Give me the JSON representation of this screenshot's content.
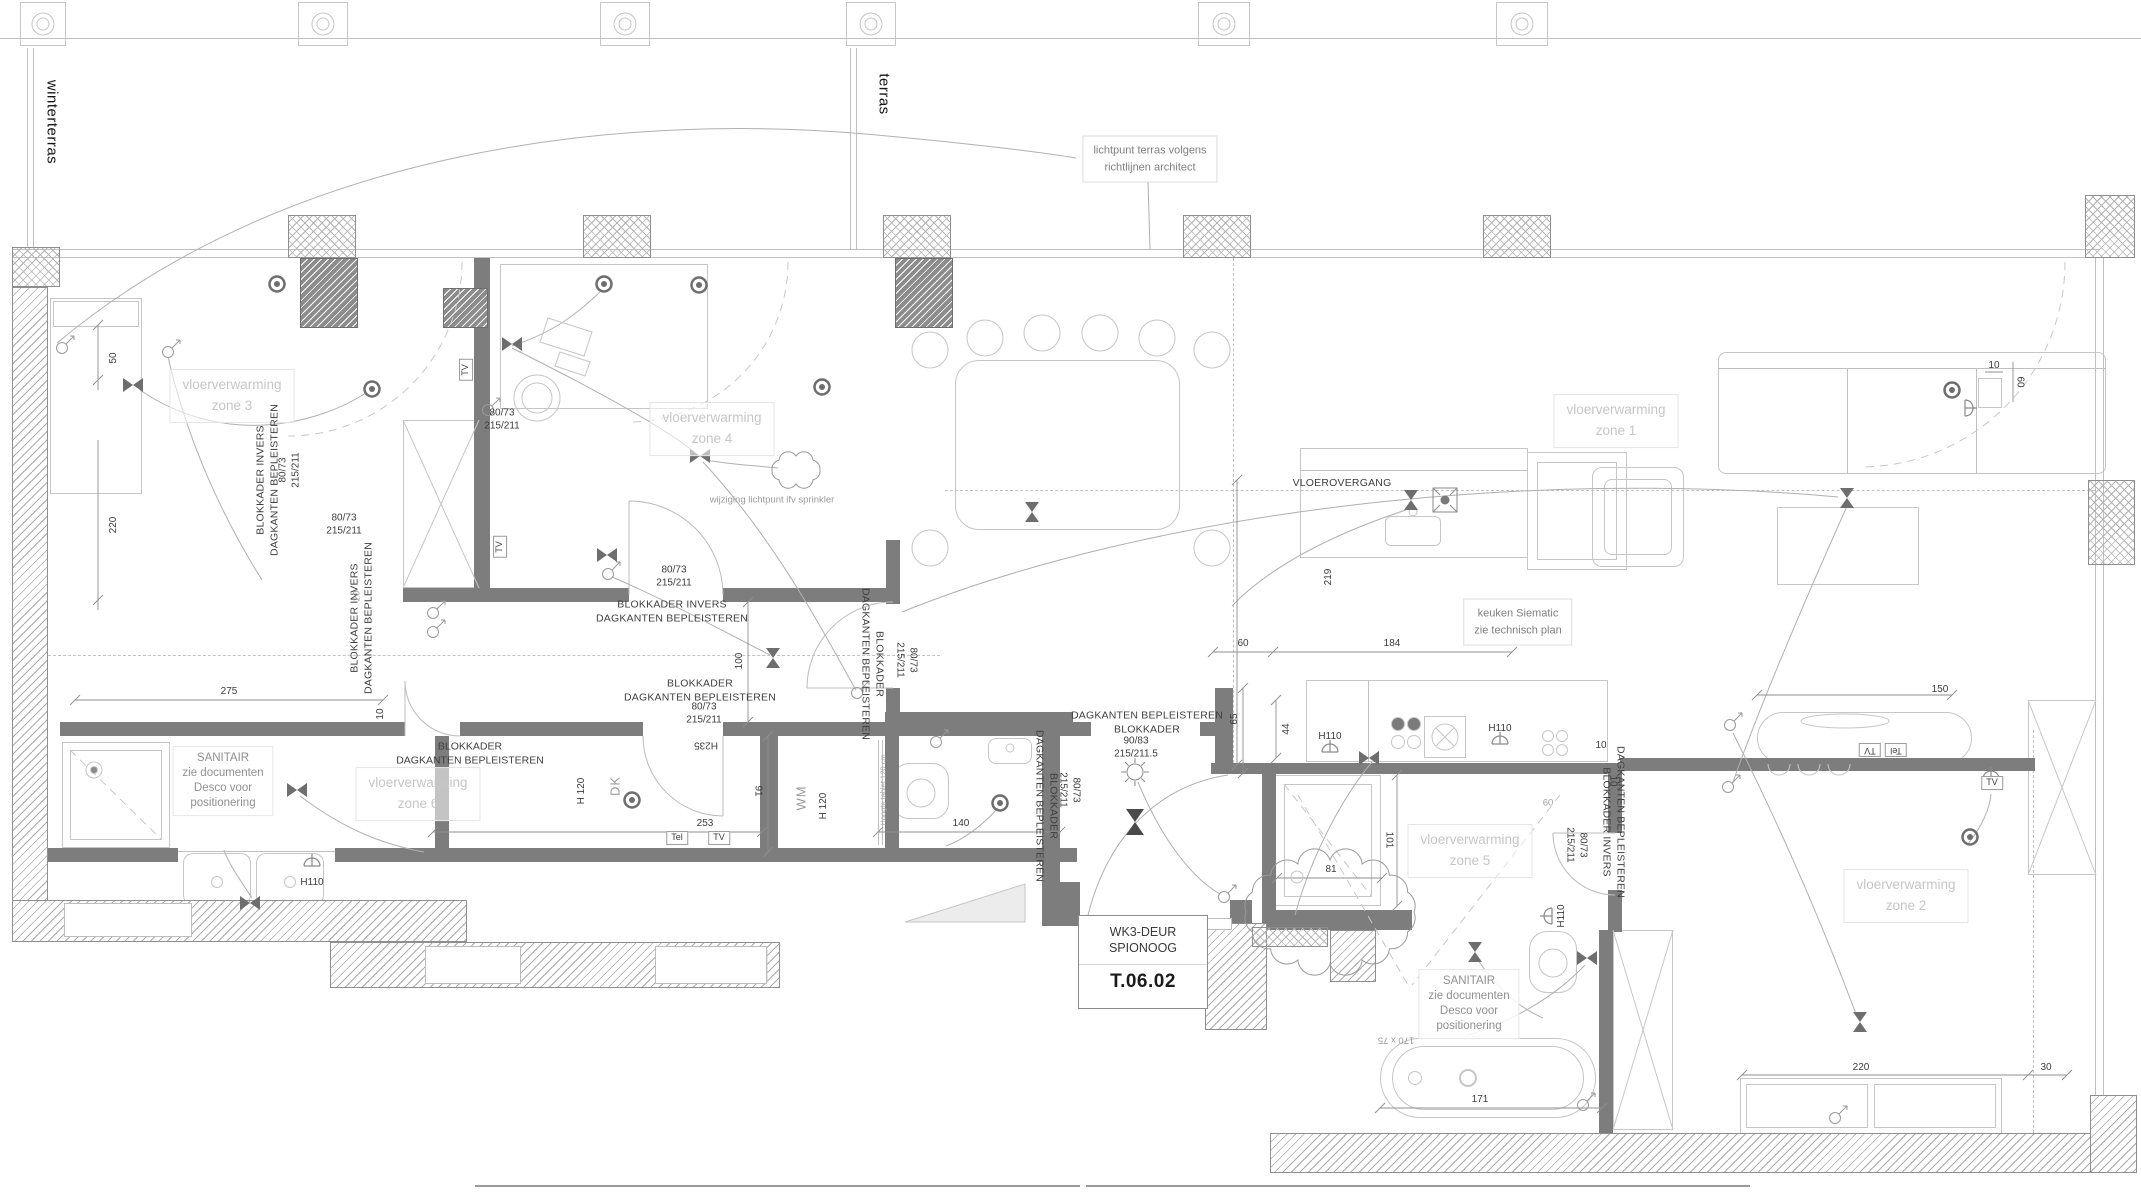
{
  "colors": {
    "wall": "#7d7d7d",
    "annotation": "#3f3f3f",
    "zone_label": "#c6c6c6",
    "dim_text": "#3c3c3c",
    "accent_none": "#ffffff"
  },
  "entry_door_tag": {
    "line1": "WK3-DEUR",
    "line2": "SPIONOOG",
    "code": "T.06.02"
  },
  "labels": [
    {
      "n": "label-winterterras",
      "t": "winterterras",
      "x": 52,
      "y": 122,
      "r": 90,
      "c": "big"
    },
    {
      "n": "label-terras",
      "t": "terras",
      "x": 884,
      "y": 94,
      "r": 90,
      "c": "big"
    },
    {
      "n": "note-lichtpunt-terras",
      "t": "lichtpunt terras volgens\nrichtlijnen architect",
      "x": 1150,
      "y": 159,
      "c": "notebox"
    },
    {
      "n": "zone-label-3",
      "t": "vloerverwarming\nzone 3",
      "x": 232,
      "y": 396,
      "c": "zone"
    },
    {
      "n": "zone-label-4",
      "t": "vloerverwarming\nzone 4",
      "x": 712,
      "y": 429,
      "c": "zone"
    },
    {
      "n": "zone-label-1",
      "t": "vloerverwarming\nzone 1",
      "x": 1616,
      "y": 421,
      "c": "zone"
    },
    {
      "n": "zone-label-2",
      "t": "vloerverwarming\nzone 2",
      "x": 1906,
      "y": 896,
      "c": "zone"
    },
    {
      "n": "zone-label-5",
      "t": "vloerverwarming\nzone 5",
      "x": 1470,
      "y": 851,
      "c": "zone"
    },
    {
      "n": "zone-label-6",
      "t": "vloerverwarming\nzone 6",
      "x": 418,
      "y": 794,
      "c": "zone"
    },
    {
      "n": "note-sanitair-left",
      "t": "SANITAIR\nzie documenten\nDesco voor\npositionering",
      "x": 223,
      "y": 781,
      "c": "sanit"
    },
    {
      "n": "note-sanitair-right",
      "t": "SANITAIR\nzie documenten\nDesco voor\npositionering",
      "x": 1469,
      "y": 1004,
      "c": "sanit"
    },
    {
      "n": "note-blokkader-invers",
      "t": "BLOKKADER INVERS\nDAGKANTEN BEPLEISTEREN",
      "x": 672,
      "y": 612,
      "c": "note"
    },
    {
      "n": "note-blokkader",
      "t": "BLOKKADER\nDAGKANTEN BEPLEISTEREN",
      "x": 700,
      "y": 691,
      "c": "note"
    },
    {
      "n": "door-spec",
      "t": "80/73\n215/211",
      "x": 674,
      "y": 577,
      "c": "dim"
    },
    {
      "n": "door-spec",
      "t": "80/73\n215/211",
      "x": 704,
      "y": 714,
      "c": "dim"
    },
    {
      "n": "note-blokkader",
      "t": "BLOKKADER\nDAGKANTEN BEPLEISTEREN",
      "x": 470,
      "y": 754,
      "c": "noteL"
    },
    {
      "n": "note-entry-door",
      "t": "DAGKANTEN BEPLEISTEREN\nBLOKKADER",
      "x": 1147,
      "y": 723,
      "c": "note"
    },
    {
      "n": "door-spec-entry",
      "t": "90/83\n215/211.5",
      "x": 1136,
      "y": 748,
      "c": "dim"
    },
    {
      "n": "door-spec",
      "t": "80/73\n215/211",
      "x": 502,
      "y": 420,
      "c": "dim"
    },
    {
      "n": "door-spec",
      "t": "80/73\n215/211",
      "x": 344,
      "y": 525,
      "c": "dim"
    },
    {
      "n": "note-blokkader-v",
      "t": "BLOKKADER INVERS\nDAGKANTEN BEPLEISTEREN",
      "x": 268,
      "y": 480,
      "r": -90,
      "c": "note"
    },
    {
      "n": "note-blokkader-v",
      "t": "BLOKKADER INVERS\nDAGKANTEN BEPLEISTEREN",
      "x": 362,
      "y": 618,
      "r": -90,
      "c": "note"
    },
    {
      "n": "note-blokkader-v",
      "t": "BLOKKADER\nDAGKANTEN BEPLEISTEREN",
      "x": 872,
      "y": 664,
      "r": 90,
      "c": "note"
    },
    {
      "n": "door-spec",
      "t": "80/73\n215/211",
      "x": 906,
      "y": 660,
      "r": 90,
      "c": "dim"
    },
    {
      "n": "note-blokkader-v",
      "t": "BLOKKADER\nDAGKANTEN BEPLEISTEREN",
      "x": 1046,
      "y": 806,
      "r": 90,
      "c": "note"
    },
    {
      "n": "door-spec",
      "t": "80/73\n215/211",
      "x": 1069,
      "y": 790,
      "r": 90,
      "c": "dim"
    },
    {
      "n": "note-blokkader-v",
      "t": "DAGKANTEN BEPLEISTEREN\nBLOKKADER INVERS",
      "x": 1613,
      "y": 822,
      "r": 90,
      "c": "note"
    },
    {
      "n": "door-spec",
      "t": "80/73\n215/211",
      "x": 1576,
      "y": 845,
      "r": 90,
      "c": "dim"
    },
    {
      "n": "door-spec",
      "t": "80/73\n215/211",
      "x": 290,
      "y": 470,
      "r": -90,
      "c": "dim"
    },
    {
      "n": "note-wijziging",
      "t": "wijziging lichtpunt ifv sprinkler",
      "x": 772,
      "y": 500,
      "c": "small"
    },
    {
      "n": "label-vloerovergang",
      "t": "VLOEROVERGANG",
      "x": 1342,
      "y": 484,
      "c": "note"
    },
    {
      "n": "note-keuken",
      "t": "keuken Siematic\nzie technisch plan",
      "x": 1518,
      "y": 622,
      "c": "notebox"
    },
    {
      "n": "dim-275",
      "t": "275",
      "x": 229,
      "y": 692,
      "c": "dim"
    },
    {
      "n": "dim-253",
      "t": "253",
      "x": 705,
      "y": 824,
      "c": "dim"
    },
    {
      "n": "dim-140",
      "t": "140",
      "x": 961,
      "y": 824,
      "c": "dim"
    },
    {
      "n": "dim-91",
      "t": "91",
      "x": 757,
      "y": 791,
      "r": 90,
      "c": "dim"
    },
    {
      "n": "dim-100",
      "t": "100",
      "x": 740,
      "y": 661,
      "r": -90,
      "c": "dim"
    },
    {
      "n": "dim-60",
      "t": "60",
      "x": 1243,
      "y": 644,
      "c": "dim"
    },
    {
      "n": "dim-184",
      "t": "184",
      "x": 1392,
      "y": 644,
      "c": "dim"
    },
    {
      "n": "dim-219",
      "t": "219",
      "x": 1329,
      "y": 577,
      "r": -90,
      "c": "dim"
    },
    {
      "n": "dim-65",
      "t": "65",
      "x": 1235,
      "y": 719,
      "r": -90,
      "c": "dim"
    },
    {
      "n": "dim-44",
      "t": "44",
      "x": 1287,
      "y": 729,
      "r": -90,
      "c": "dim"
    },
    {
      "n": "dim-101",
      "t": "101",
      "x": 1388,
      "y": 840,
      "r": 90,
      "c": "dim"
    },
    {
      "n": "dim-81",
      "t": "81",
      "x": 1331,
      "y": 870,
      "c": "dim"
    },
    {
      "n": "dim-171",
      "t": "171",
      "x": 1480,
      "y": 1100,
      "c": "dim"
    },
    {
      "n": "dim-220",
      "t": "220",
      "x": 1861,
      "y": 1068,
      "c": "dim"
    },
    {
      "n": "dim-30",
      "t": "30",
      "x": 2046,
      "y": 1068,
      "c": "dim"
    },
    {
      "n": "dim-150",
      "t": "150",
      "x": 1940,
      "y": 690,
      "c": "dim"
    },
    {
      "n": "dim-10",
      "t": "10",
      "x": 1601,
      "y": 746,
      "c": "dim"
    },
    {
      "n": "dim-10",
      "t": "10",
      "x": 1612,
      "y": 781,
      "r": 90,
      "c": "dim"
    },
    {
      "n": "dim-50",
      "t": "50",
      "x": 114,
      "y": 358,
      "r": -90,
      "c": "dim"
    },
    {
      "n": "dim-220b",
      "t": "220",
      "x": 114,
      "y": 525,
      "r": -90,
      "c": "dim"
    },
    {
      "n": "dim-10",
      "t": "10",
      "x": 381,
      "y": 714,
      "r": -90,
      "c": "dim"
    },
    {
      "n": "dim-10",
      "t": "10",
      "x": 1994,
      "y": 366,
      "c": "dim"
    },
    {
      "n": "dim-60b",
      "t": "60",
      "x": 2019,
      "y": 382,
      "r": 90,
      "c": "dim"
    },
    {
      "n": "dim-60c",
      "t": "60",
      "x": 1548,
      "y": 803,
      "c": "dimg"
    },
    {
      "n": "dim-20",
      "t": "20",
      "x": 357,
      "y": 596,
      "r": -90,
      "c": "dimg"
    },
    {
      "n": "label-h235",
      "t": "H235",
      "x": 706,
      "y": 744,
      "r": 180,
      "c": "dim"
    },
    {
      "n": "label-h120",
      "t": "H 120",
      "x": 582,
      "y": 791,
      "r": -90,
      "c": "dim"
    },
    {
      "n": "label-h120",
      "t": "H 120",
      "x": 824,
      "y": 806,
      "r": -90,
      "c": "dim"
    },
    {
      "n": "label-dk",
      "t": "DK",
      "x": 615,
      "y": 786,
      "r": -90,
      "c": "mid"
    },
    {
      "n": "label-wm",
      "t": "WM",
      "x": 801,
      "y": 798,
      "r": -90,
      "c": "mid"
    },
    {
      "n": "label-hoogte-tablet",
      "t": "Hoogte tablet 120 cm",
      "x": 883,
      "y": 790,
      "r": -90,
      "c": "tiny"
    },
    {
      "n": "label-h110",
      "t": "H110",
      "x": 312,
      "y": 883,
      "c": "dim"
    },
    {
      "n": "label-h110",
      "t": "H110",
      "x": 1330,
      "y": 737,
      "c": "dim"
    },
    {
      "n": "label-h110",
      "t": "H110",
      "x": 1500,
      "y": 729,
      "c": "dim"
    },
    {
      "n": "label-h110",
      "t": "H110",
      "x": 1562,
      "y": 916,
      "r": -90,
      "c": "dim"
    },
    {
      "n": "label-bath-size",
      "t": "170  x  75",
      "x": 1396,
      "y": 1040,
      "r": 180,
      "c": "small"
    },
    {
      "n": "tag-tel",
      "t": "Tel",
      "x": 677,
      "y": 838,
      "c": "tag"
    },
    {
      "n": "tag-tv",
      "t": "TV",
      "x": 719,
      "y": 838,
      "c": "tag"
    },
    {
      "n": "tag-tv",
      "t": "TV",
      "x": 466,
      "y": 370,
      "r": -90,
      "c": "tag"
    },
    {
      "n": "tag-tv",
      "t": "TV",
      "x": 500,
      "y": 547,
      "r": -90,
      "c": "tag"
    },
    {
      "n": "tag-tv",
      "t": "TV",
      "x": 1992,
      "y": 783,
      "c": "tag"
    },
    {
      "n": "tag-tv",
      "t": "TV",
      "x": 1870,
      "y": 750,
      "r": 180,
      "c": "tag"
    },
    {
      "n": "tag-tel",
      "t": "Tel",
      "x": 1896,
      "y": 750,
      "r": 180,
      "c": "tag"
    }
  ]
}
